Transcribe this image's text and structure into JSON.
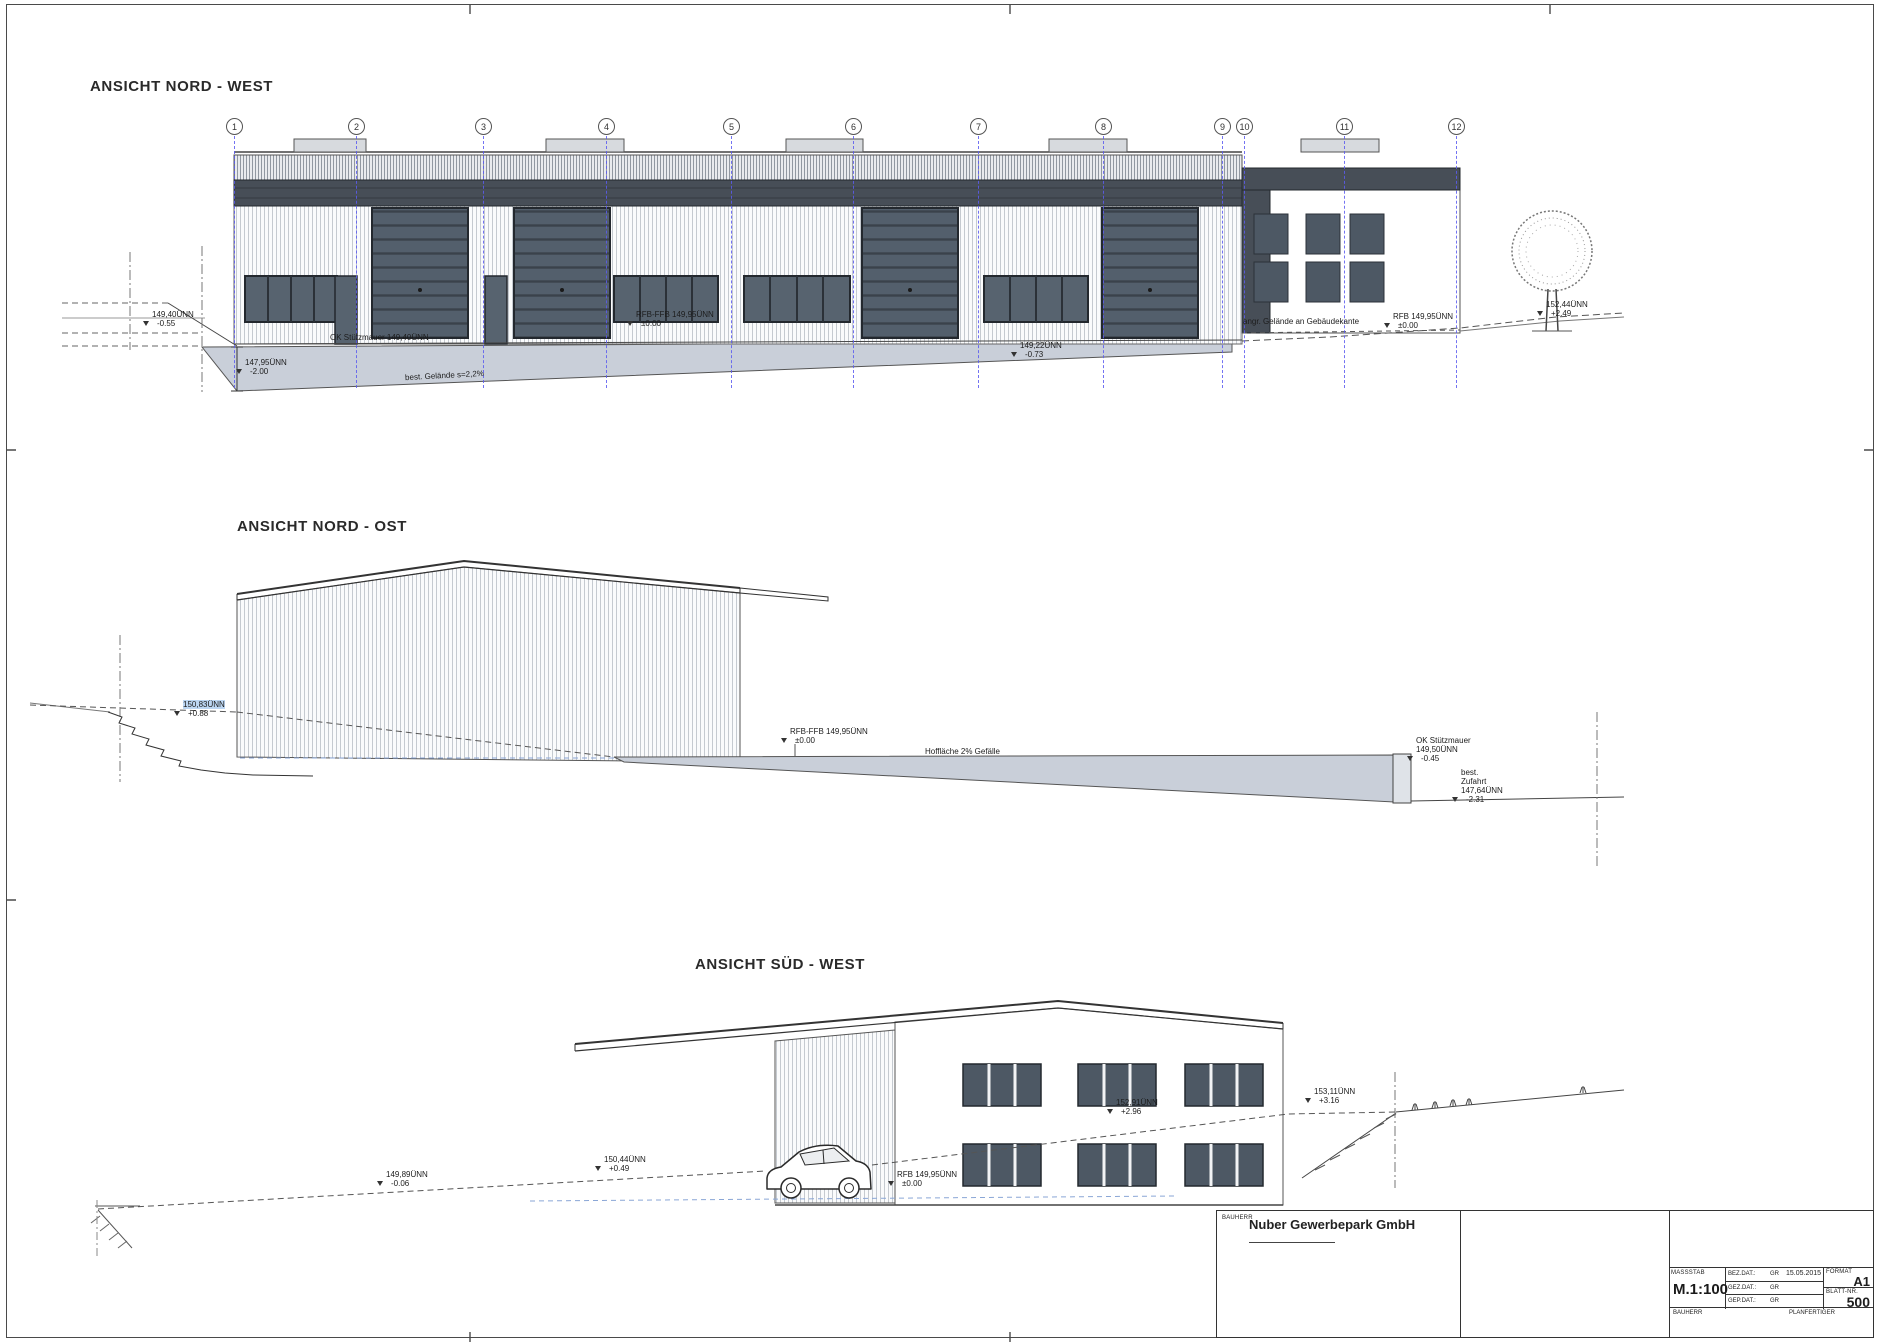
{
  "sheet": {
    "kind": "architectural elevation sheet"
  },
  "colors": {
    "dark_panel": "#474e57",
    "window_glass": "#57636f",
    "garage_door": "#535f6c",
    "ground_wedge": "#c9cfd9",
    "grid_blue": "#5b5bf0",
    "outline": "#3f3f3f"
  },
  "views": [
    {
      "id": "nord-west",
      "title": "ANSICHT NORD - WEST",
      "grid_labels": [
        "1",
        "2",
        "3",
        "4",
        "5",
        "6",
        "7",
        "8",
        "9",
        "10",
        "11",
        "12"
      ],
      "annotations": [
        {
          "lines": [
            "149,40ÜNN",
            "-0.55"
          ],
          "x": 152,
          "y": 310,
          "tri": true
        },
        {
          "lines": [
            "147,95ÜNN",
            "-2.00"
          ],
          "x": 245,
          "y": 358,
          "tri": true
        },
        {
          "lines": [
            "OK Stützmauer 149,40ÜNN"
          ],
          "x": 330,
          "y": 333
        },
        {
          "lines": [
            "RFB-FFB 149,95ÜNN",
            "±0.00"
          ],
          "x": 636,
          "y": 310,
          "tri": true
        },
        {
          "lines": [
            "best. Gelände s=2,2%"
          ],
          "x": 405,
          "y": 371,
          "rot": -3
        },
        {
          "lines": [
            "149,22ÜNN",
            "-0.73"
          ],
          "x": 1020,
          "y": 341,
          "tri": true
        },
        {
          "lines": [
            "angr. Gelände an Gebäudekante"
          ],
          "x": 1243,
          "y": 317
        },
        {
          "lines": [
            "RFB 149,95ÜNN",
            "±0.00"
          ],
          "x": 1393,
          "y": 312,
          "tri": true
        },
        {
          "lines": [
            "152,44ÜNN",
            "+2.49"
          ],
          "x": 1546,
          "y": 300,
          "tri": true
        }
      ]
    },
    {
      "id": "nord-ost",
      "title": "ANSICHT NORD - OST",
      "annotations": [
        {
          "lines": [
            "150,83ÜNN",
            "+0.88"
          ],
          "x": 183,
          "y": 700,
          "tri": true,
          "hl": true
        },
        {
          "lines": [
            "RFB-FFB 149,95ÜNN",
            "±0.00"
          ],
          "x": 790,
          "y": 727,
          "tri": true
        },
        {
          "lines": [
            "Hoffläche 2% Gefälle"
          ],
          "x": 925,
          "y": 747
        },
        {
          "lines": [
            "OK Stützmauer",
            "149,50ÜNN",
            "-0.45"
          ],
          "x": 1416,
          "y": 736,
          "tri": true
        },
        {
          "lines": [
            "best.",
            "Zufahrt",
            "147,64ÜNN",
            "-2.31"
          ],
          "x": 1461,
          "y": 768,
          "tri": true
        }
      ]
    },
    {
      "id": "sued-west",
      "title": "ANSICHT SÜD - WEST",
      "annotations": [
        {
          "lines": [
            "149,89ÜNN",
            "-0.06"
          ],
          "x": 386,
          "y": 1170,
          "tri": true
        },
        {
          "lines": [
            "150,44ÜNN",
            "+0.49"
          ],
          "x": 604,
          "y": 1155,
          "tri": true
        },
        {
          "lines": [
            "RFB 149,95ÜNN",
            "±0.00"
          ],
          "x": 897,
          "y": 1170,
          "tri": true
        },
        {
          "lines": [
            "152,91ÜNN",
            "+2.96"
          ],
          "x": 1116,
          "y": 1098,
          "tri": true
        },
        {
          "lines": [
            "153,11ÜNN",
            "+3.16"
          ],
          "x": 1314,
          "y": 1087,
          "tri": true
        }
      ]
    }
  ],
  "title_block": {
    "bauherr_label": "BAUHERR",
    "bauherr_value": "Nuber Gewerbepark GmbH",
    "massstab_label": "MASSSTAB",
    "massstab_value": "M.1:100",
    "date_rows": [
      {
        "label": "BEZ.DAT.:",
        "initials": "GR",
        "date": "15.05.2015"
      },
      {
        "label": "GEZ.DAT.:",
        "initials": "GR",
        "date": ""
      },
      {
        "label": "GEP.DAT.:",
        "initials": "GR",
        "date": ""
      }
    ],
    "format_label": "FORMAT",
    "format_value": "A1",
    "blatt_label": "BLATT-NR.",
    "blatt_value": "500",
    "bauherr_cell_label": "BAUHERR",
    "planfertiger_cell_label": "PLANFERTIGER"
  }
}
